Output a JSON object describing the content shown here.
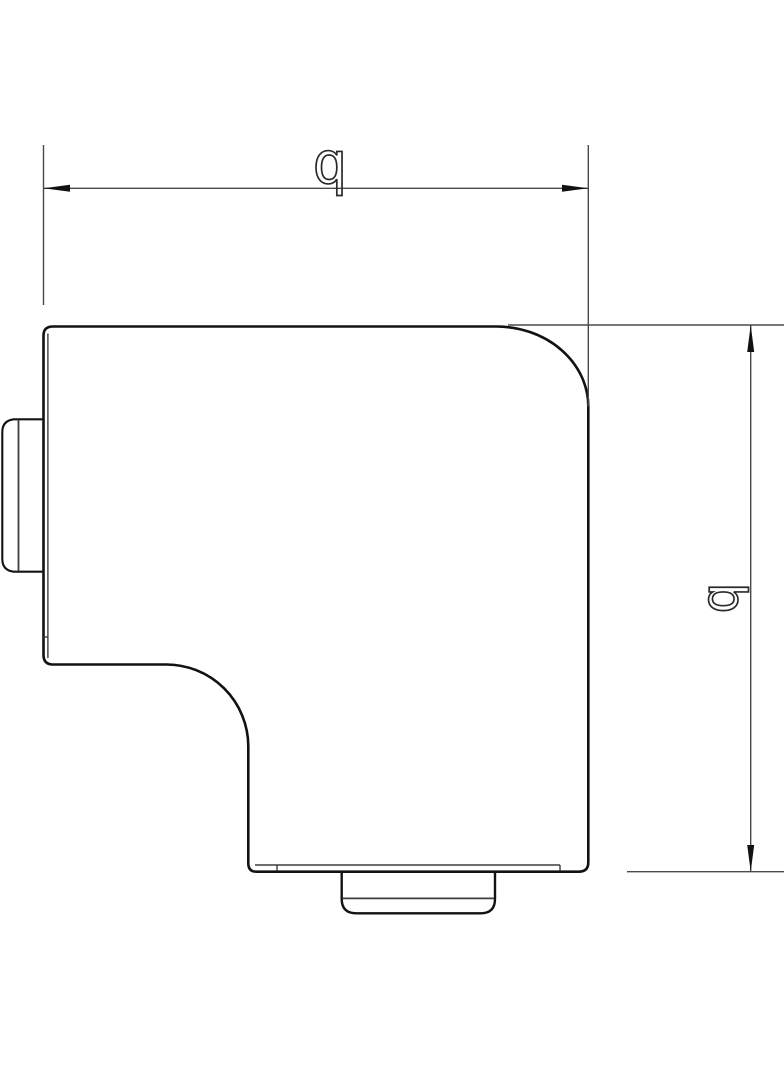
{
  "drawing": {
    "title": "flat-angle-dimension-drawing",
    "dimensions": {
      "horizontal": {
        "label": "b"
      },
      "vertical": {
        "label": "b"
      }
    }
  },
  "colors": {
    "background": "#ffffff",
    "outline": "#121212",
    "thin_line": "#3d3d3d",
    "dimension_line": "#4a4a4a",
    "arrow_fill": "#121212"
  }
}
